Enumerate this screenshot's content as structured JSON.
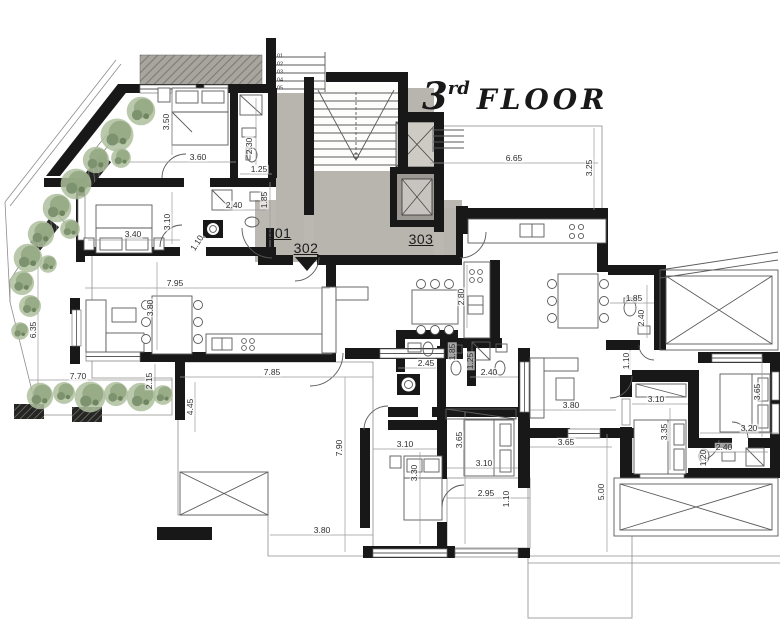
{
  "title": {
    "number": "3",
    "ordinal": "rd",
    "word": "FLOOR"
  },
  "apartments": [
    {
      "label": "301"
    },
    {
      "label": "302"
    },
    {
      "label": "303"
    }
  ],
  "stairs": {
    "treads": [
      "01",
      "02",
      "03",
      "04",
      "05"
    ]
  },
  "dimensions": [
    {
      "label": "3.50"
    },
    {
      "label": "3.60"
    },
    {
      "label": "2.30"
    },
    {
      "label": "1.25"
    },
    {
      "label": "2.40"
    },
    {
      "label": "1.85"
    },
    {
      "label": "3.40"
    },
    {
      "label": "3.10"
    },
    {
      "label": "1.10"
    },
    {
      "label": "7.95"
    },
    {
      "label": "3.80"
    },
    {
      "label": "6.35"
    },
    {
      "label": "7.70"
    },
    {
      "label": "2.15"
    },
    {
      "label": "4.45"
    },
    {
      "label": "7.85"
    },
    {
      "label": "7.90"
    },
    {
      "label": "3.80"
    },
    {
      "label": "2.80"
    },
    {
      "label": "2.45"
    },
    {
      "label": "1.85"
    },
    {
      "label": "1.25"
    },
    {
      "label": "2.40"
    },
    {
      "label": "3.10"
    },
    {
      "label": "3.30"
    },
    {
      "label": "3.65"
    },
    {
      "label": "3.10"
    },
    {
      "label": "2.95"
    },
    {
      "label": "1.10"
    },
    {
      "label": "6.65"
    },
    {
      "label": "3.25"
    },
    {
      "label": "1.85"
    },
    {
      "label": "2.40"
    },
    {
      "label": "1.10"
    },
    {
      "label": "3.80"
    },
    {
      "label": "3.65"
    },
    {
      "label": "5.00"
    },
    {
      "label": "3.10"
    },
    {
      "label": "3.35"
    },
    {
      "label": "3.65"
    },
    {
      "label": "3.20"
    },
    {
      "label": "2.40"
    },
    {
      "label": "1.20"
    }
  ],
  "colors": {
    "wall": "#181818",
    "concrete": "#b8b5af",
    "terrace_fill": "#f2f1ee",
    "terrace_grid": "#dbd9d5",
    "plant_green": "#94a883",
    "paper": "#ffffff"
  }
}
